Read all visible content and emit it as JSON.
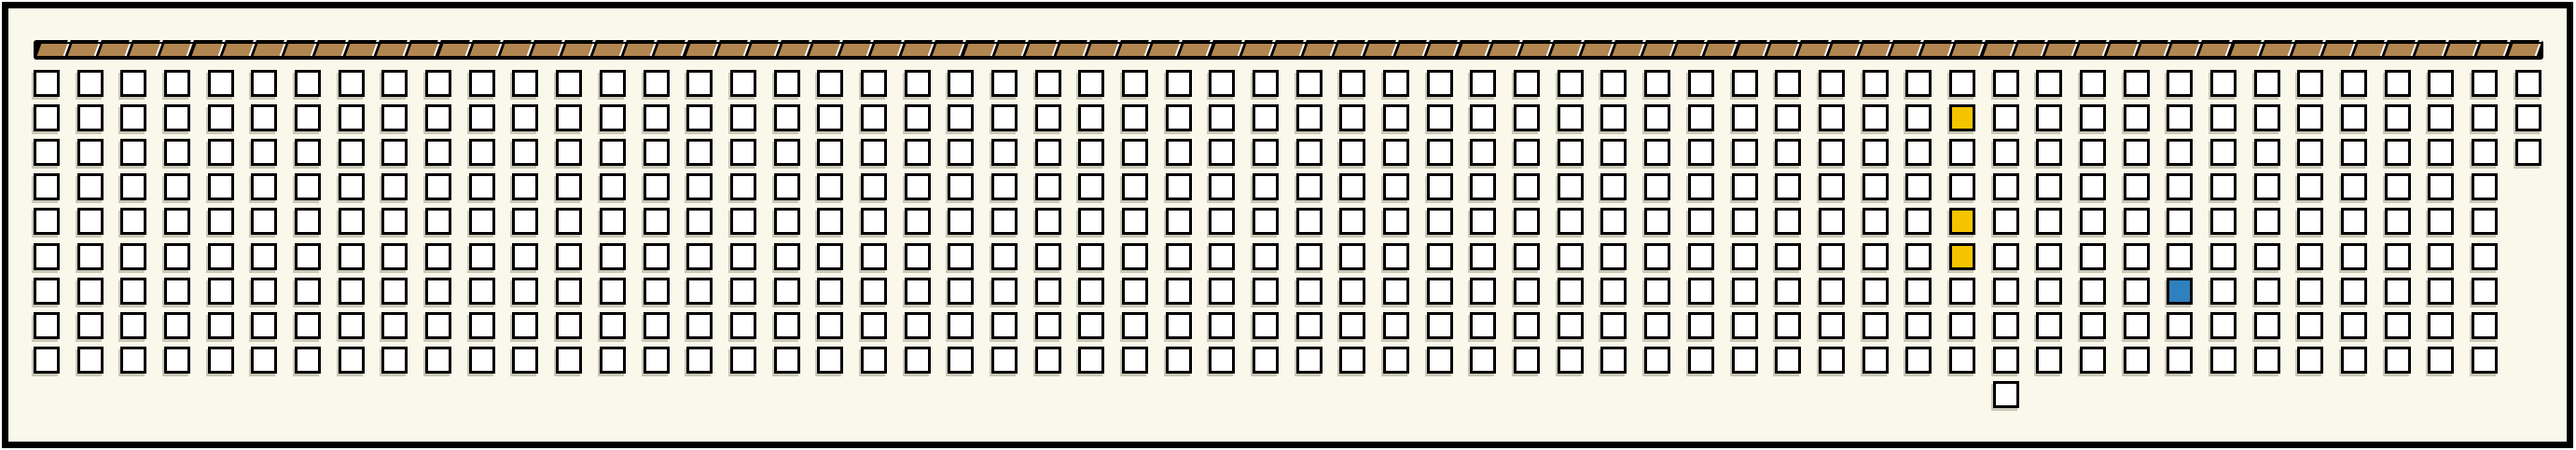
{
  "panel": {
    "kind": "seat-map-grid",
    "band": {
      "segment_count": 81
    },
    "grid": {
      "columns": 58,
      "rows": 9,
      "short_last_column": {
        "col_index": 57,
        "rows_present": 3
      },
      "extra_cell_below": {
        "row_index": 9,
        "col_index": 45
      },
      "highlighted_cells": [
        {
          "row_index": 1,
          "col_index": 44,
          "color": "yellow"
        },
        {
          "row_index": 4,
          "col_index": 44,
          "color": "yellow"
        },
        {
          "row_index": 5,
          "col_index": 44,
          "color": "yellow"
        },
        {
          "row_index": 6,
          "col_index": 49,
          "color": "blue"
        }
      ]
    }
  },
  "colors": {
    "background": "#FAF8EA",
    "frame_border": "#000000",
    "cell_fill": "#FFFFFF",
    "cell_border": "#000000",
    "band_background": "#000000",
    "band_segment": "#B28650",
    "band_separator": "#FFFFFF",
    "yellow": "#F5C400",
    "blue": "#2E80BE"
  }
}
